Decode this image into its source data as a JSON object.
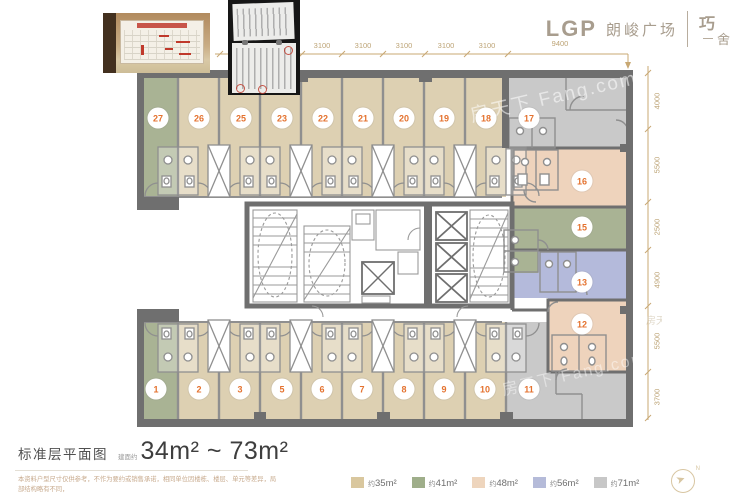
{
  "brand": {
    "abbr": "LGP",
    "name": "朗峻广场",
    "seal_top": "巧",
    "seal_bottom": "舍"
  },
  "title": {
    "plan_label": "标准层平面图",
    "area_prefix": "建面约",
    "area_range": "34m² ~ 73m²"
  },
  "disclaimer": {
    "line1": "本资料户型尺寸仅供参考，不作为要约或销售承诺，相同单位因楼栋、楼层、单元等差异，局部结构略有不同，",
    "line2": "实际销售及交房尺寸以双方合同约定及政府部门最终审批结果为准。"
  },
  "legend": {
    "items": [
      {
        "prefix": "约",
        "value": "35m²",
        "color": "#d9c79e"
      },
      {
        "prefix": "约",
        "value": "41m²",
        "color": "#9fae8a"
      },
      {
        "prefix": "约",
        "value": "48m²",
        "color": "#eed5bd"
      },
      {
        "prefix": "约",
        "value": "56m²",
        "color": "#b5bbd9"
      },
      {
        "prefix": "约",
        "value": "71m²",
        "color": "#c7c7c7"
      }
    ]
  },
  "dimensions": {
    "top": [
      "3100",
      "3100",
      "3100",
      "3100",
      "3100",
      "9400"
    ],
    "right": [
      "4000",
      "5500",
      "2500",
      "4900",
      "5500",
      "3700"
    ]
  },
  "units": {
    "top": [
      "27",
      "26",
      "25",
      "23",
      "22",
      "21",
      "20",
      "19",
      "18",
      "17"
    ],
    "bottom": [
      "1",
      "2",
      "3",
      "5",
      "6",
      "7",
      "8",
      "9",
      "10",
      "11"
    ],
    "right": [
      "16",
      "15",
      "13",
      "12"
    ]
  },
  "plan_colors": {
    "wall": "#6f6f6f",
    "tan": "#ddd0b2",
    "green": "#a9b394",
    "peach": "#eed3bc",
    "blue": "#b4badb",
    "gray": "#c9c9c9"
  },
  "watermark": {
    "text": "房天下 Fang.com"
  },
  "compass": {
    "label": "N"
  }
}
